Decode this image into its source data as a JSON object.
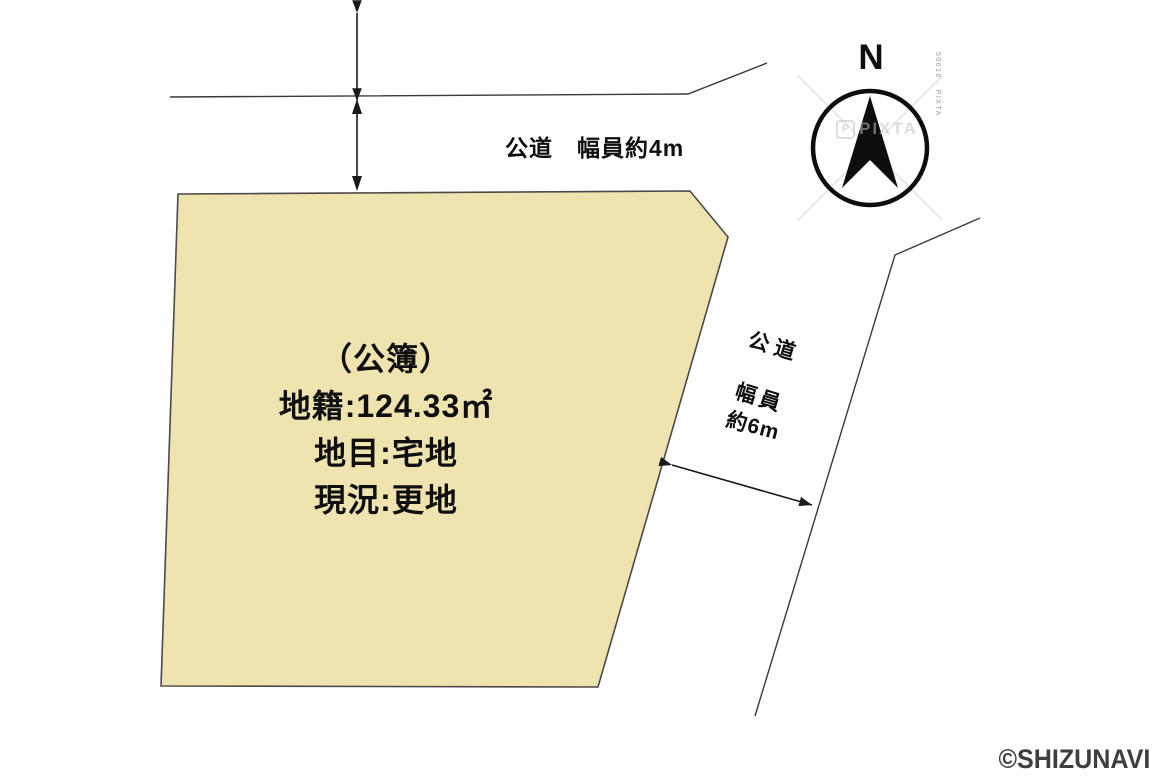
{
  "parcel": {
    "fill_color": "#efe4af",
    "info": {
      "line1": "（公簿）",
      "line2": "地籍:124.33㎡",
      "line3": "地目:宅地",
      "line4": "現況:更地"
    }
  },
  "roads": {
    "top": {
      "label": "公道　幅員約4m"
    },
    "right": {
      "name_label": "公道",
      "width_label": "幅員",
      "width_value": "約6m"
    }
  },
  "compass": {
    "north_label": "N"
  },
  "watermark": {
    "logo_letter": "P",
    "logo_text": "PIXTA",
    "side_code": "50616 - PIXTA"
  },
  "copyright": "©SHIZUNAVI"
}
